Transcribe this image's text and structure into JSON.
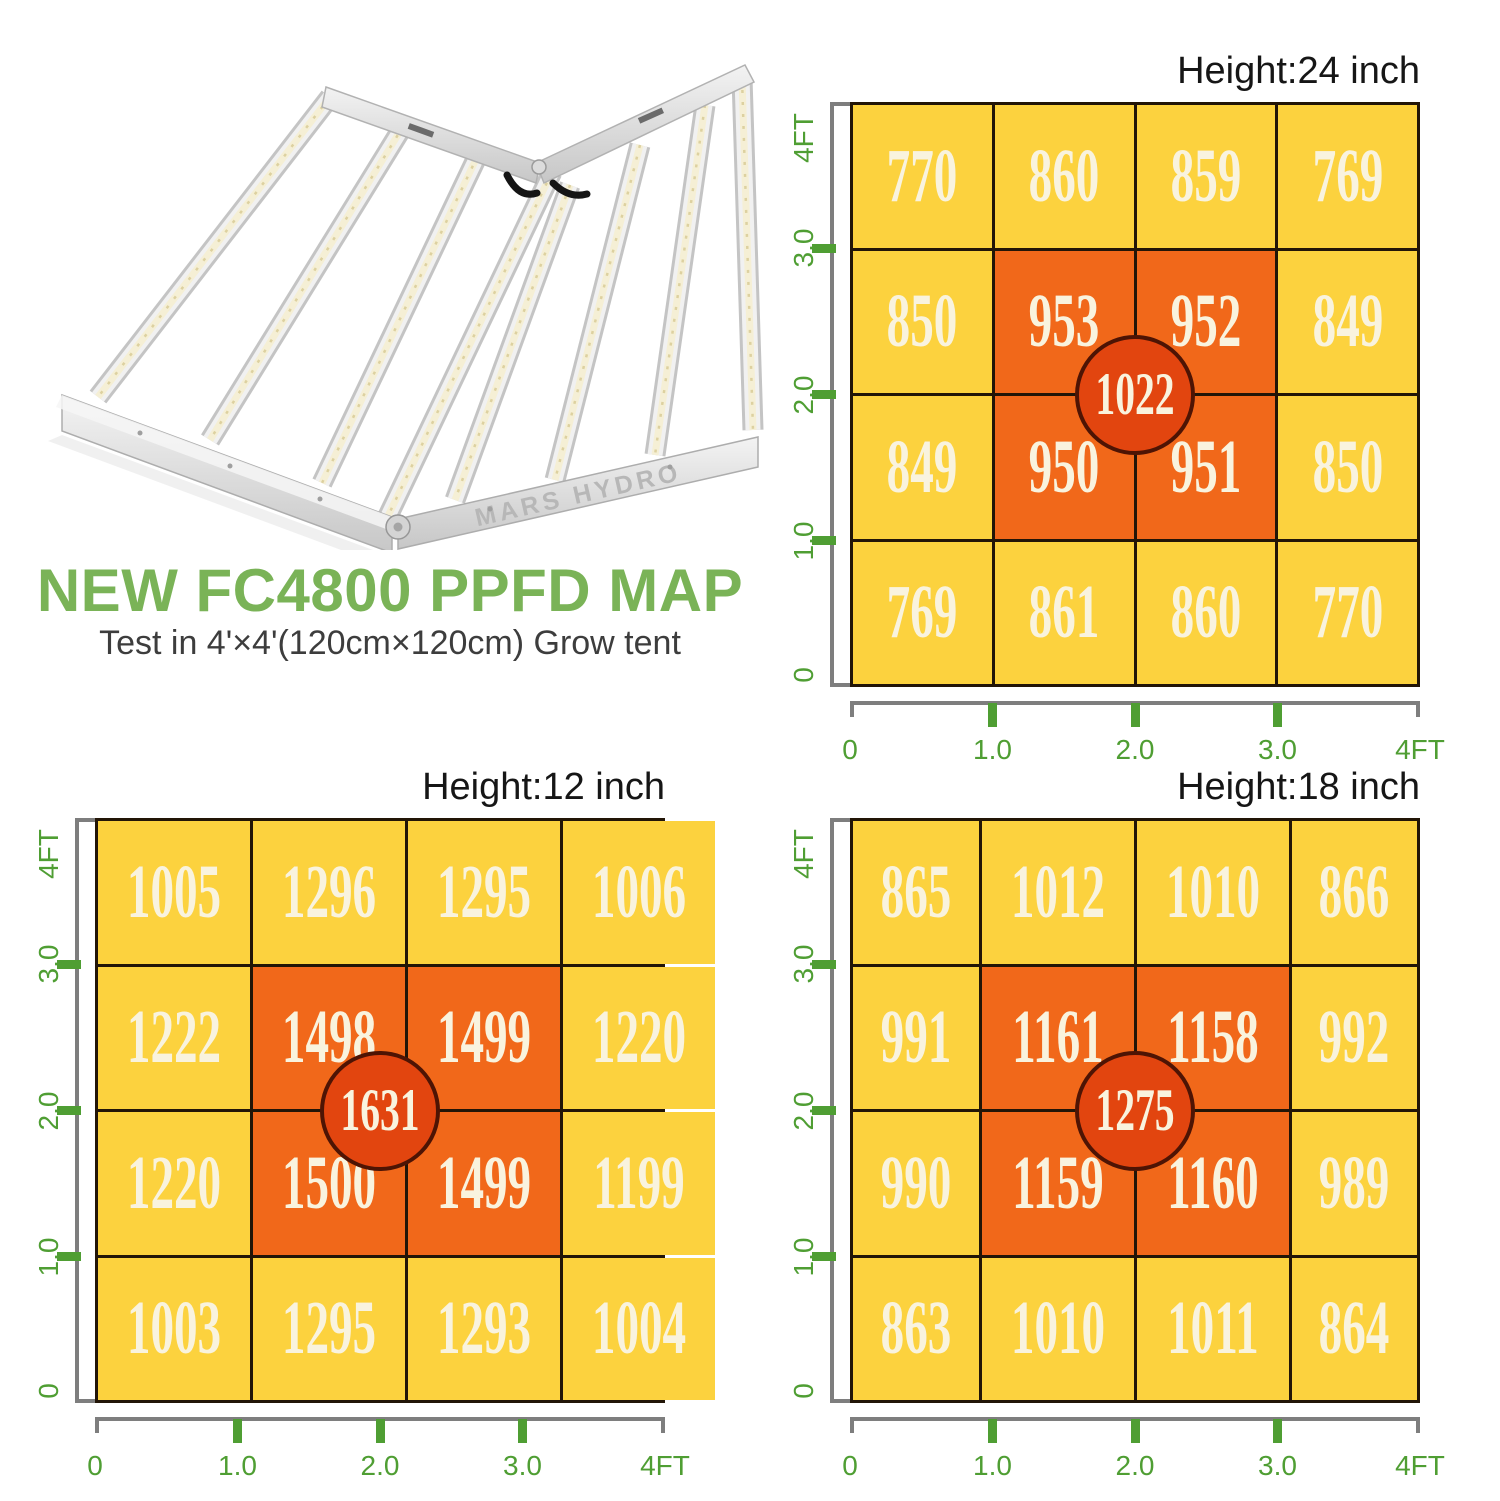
{
  "product": {
    "name": "NEW FC4800 PPFD MAP",
    "subtitle": "Test in 4'×4'(120cm×120cm) Grow tent",
    "brand": "MARS HYDRO"
  },
  "colors": {
    "title_green": "#7ab357",
    "axis_green": "#4f9e33",
    "axis_line_gray": "#7e7e7e",
    "cell_yellow": "#fcd23e",
    "cell_orange": "#f1681a",
    "center_circle_fill": "#e2450f",
    "center_circle_border": "#4e1404",
    "grid_line": "#221507",
    "value_text_cream": "#f9f3de",
    "chart_title_black": "#161616"
  },
  "chart_data": [
    {
      "type": "heatmap",
      "title": "Height:24 inch",
      "position": "top-right",
      "x_ticks": [
        "0",
        "1.0",
        "2.0",
        "3.0",
        "4FT"
      ],
      "y_ticks": [
        "4FT",
        "3.0",
        "2.0",
        "1.0",
        "0"
      ],
      "rows": [
        [
          770,
          860,
          859,
          769
        ],
        [
          850,
          953,
          952,
          849
        ],
        [
          849,
          950,
          951,
          850
        ],
        [
          769,
          861,
          860,
          770
        ]
      ],
      "center_value": 1022,
      "layout": {
        "grid": "4x4",
        "hot_zone": "center 2x2 orange",
        "center_marker": "circle with max value"
      }
    },
    {
      "type": "heatmap",
      "title": "Height:12 inch",
      "position": "bottom-left",
      "x_ticks": [
        "0",
        "1.0",
        "2.0",
        "3.0",
        "4FT"
      ],
      "y_ticks": [
        "4FT",
        "3.0",
        "2.0",
        "1.0",
        "0"
      ],
      "rows": [
        [
          1005,
          1296,
          1295,
          1006
        ],
        [
          1222,
          1498,
          1499,
          1220
        ],
        [
          1220,
          1500,
          1499,
          1199
        ],
        [
          1003,
          1295,
          1293,
          1004
        ]
      ],
      "center_value": 1631,
      "layout": {
        "grid": "4x4",
        "hot_zone": "center 2x2 orange",
        "center_marker": "circle with max value"
      }
    },
    {
      "type": "heatmap",
      "title": "Height:18 inch",
      "position": "bottom-right",
      "x_ticks": [
        "0",
        "1.0",
        "2.0",
        "3.0",
        "4FT"
      ],
      "y_ticks": [
        "4FT",
        "3.0",
        "2.0",
        "1.0",
        "0"
      ],
      "rows": [
        [
          865,
          1012,
          1010,
          866
        ],
        [
          991,
          1161,
          1158,
          992
        ],
        [
          990,
          1159,
          1160,
          989
        ],
        [
          863,
          1010,
          1011,
          864
        ]
      ],
      "center_value": 1275,
      "layout": {
        "grid": "4x4",
        "hot_zone": "center 2x2 orange",
        "center_marker": "circle with max value"
      }
    }
  ]
}
